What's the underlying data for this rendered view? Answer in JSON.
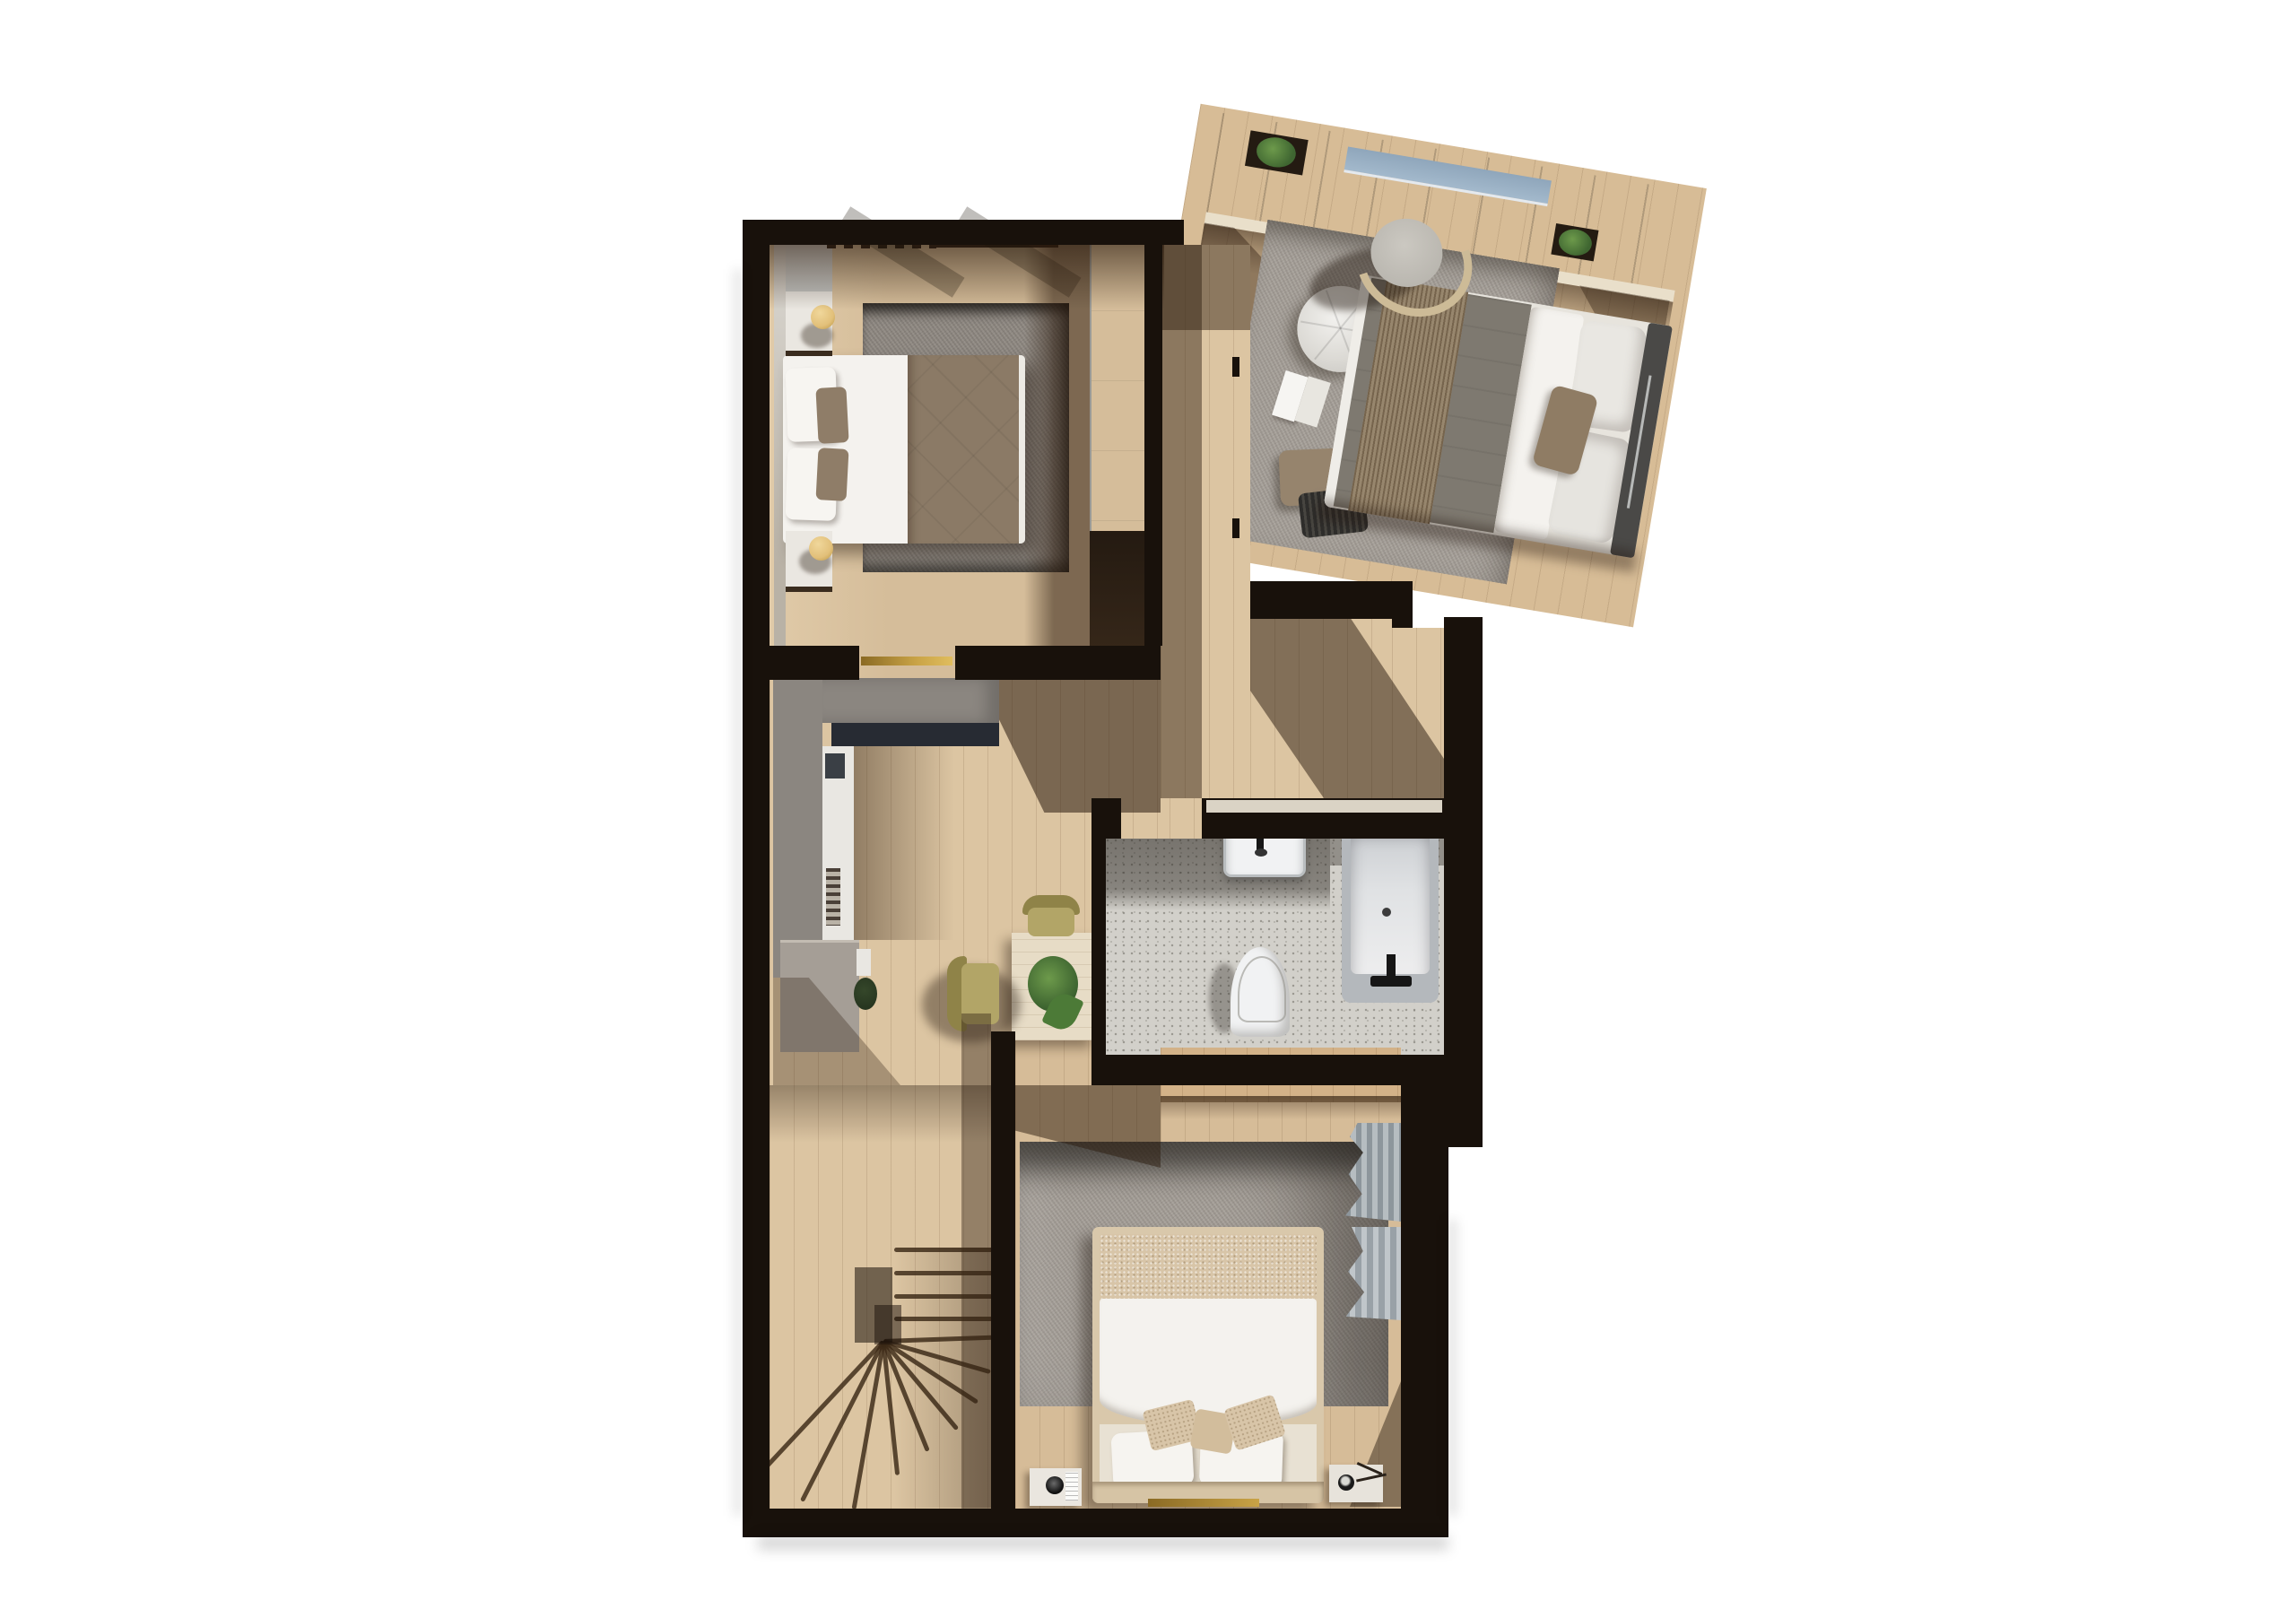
{
  "meta": {
    "title": "3D rendered floor plan — upper floor with two bedrooms, master bedroom, bathroom, landing and winder staircase"
  },
  "palette": {
    "wall": "#18110b",
    "woodHall": "#dcc5a2",
    "woodB1": "#d5bd9a",
    "woodB2": "#d6bc98",
    "woodM": "#d7bc96",
    "bath": "#d2d0ca",
    "rug1": "#8f8982",
    "rug2": "#a59f98",
    "rugM": "#a6a099",
    "white": "#f4f2ee",
    "taupe": "#8b7a66",
    "duvetM": "#7e7970",
    "throwM": "#8d7a5f",
    "blanket": "#d8c5a8",
    "tan": "#d9c8ab",
    "headboard": "#4a4947",
    "gold": "#c9a346",
    "goldDark": "#8a6a24",
    "lamp": "#e2c07a",
    "olive": "#8f8348",
    "olive2": "#b2a567",
    "green": "#3f6631",
    "green2": "#6d9a4b",
    "navy": "#272b33",
    "unit": "#8b8680",
    "cab": "#a59e96",
    "panel": "#e9e7e2",
    "ward": "#e7e9e8",
    "tubA": "#b4b8bc",
    "tubB": "#e0e2e4",
    "fix": "#161616",
    "porc": "#f1f2f3",
    "sillFace": "#e9dfca",
    "sillWood": "#3b2d1e",
    "winBlue": "#a3b9cc",
    "curtain": "#99a0a6",
    "dresser": "#d3b288"
  },
  "rooms": [
    {
      "id": "master-bedroom",
      "label": "Master bedroom (rotated wing)",
      "furniture": [
        "double-bed",
        "upholstered-headboard",
        "white-pillows",
        "taupe-accent-cushion",
        "gray-green-duvet",
        "brown-fringed-throw",
        "round-tufted-pouf",
        "open-book",
        "two-floor-cushions",
        "curved-armchair",
        "window-sill-shelf",
        "two-potted-plants",
        "picture-window",
        "large-gray-rug"
      ]
    },
    {
      "id": "bedroom-top-left",
      "label": "Bedroom — top left",
      "furniture": [
        "double-bed",
        "white-duvet",
        "taupe-duvet",
        "white-pillows",
        "taupe-pillows",
        "two-floating-nightstands",
        "two-gold-sphere-lamps",
        "wall-panels",
        "gray-rug",
        "white-wardrobe",
        "under-window-radiator",
        "brass-door-threshold"
      ]
    },
    {
      "id": "bedroom-bottom",
      "label": "Bedroom — bottom",
      "furniture": [
        "double-bed",
        "boucle-blanket",
        "white-duvet",
        "two-white-pillows",
        "three-beige-cushions",
        "two-nightstands",
        "two-small-lamps",
        "gray-patch-rug",
        "oak-sideboard",
        "gray-curtains",
        "brass-floor-strip"
      ]
    },
    {
      "id": "bathroom",
      "label": "Bathroom",
      "furniture": [
        "wall-hung-washbasin",
        "black-faucet",
        "wall-hung-toilet",
        "bathtub",
        "black-tub-mixer",
        "terrazzo-floor"
      ]
    },
    {
      "id": "landing",
      "label": "Landing / hallway",
      "furniture": [
        "built-in-desk-unit",
        "navy-inset-shelf",
        "white-side-panel",
        "low-cabinet",
        "small-plant",
        "square-side-table",
        "potted-plant",
        "two-olive-chairs",
        "winder-staircase"
      ]
    }
  ]
}
